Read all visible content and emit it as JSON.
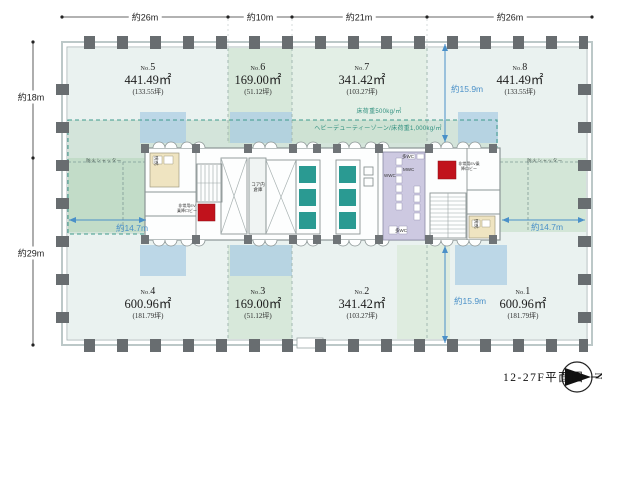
{
  "title": "12-27F平面図",
  "compass_north": "N",
  "dimensions": {
    "top": [
      "約26m",
      "約10m",
      "約21m",
      "約26m"
    ],
    "left_upper": "約18m",
    "left_lower": "約29m",
    "depth_left": "約14.7m",
    "depth_right": "約14.7m",
    "depth_top_right": "約15.9m",
    "depth_bottom_right": "約15.9m"
  },
  "floor_load": {
    "standard": "床荷重500kg/㎡",
    "heavy_duty": "ヘビーデューティーゾーン/床荷重1,000kg/㎡"
  },
  "fire_shutter_left": "防火シャッター",
  "fire_shutter_right": "防火シャッター",
  "rooms": [
    {
      "no_prefix": "No.",
      "no_number": "5",
      "area": "441.49㎡",
      "tsubo": "(133.55坪)"
    },
    {
      "no_prefix": "No.",
      "no_number": "6",
      "area": "169.00㎡",
      "tsubo": "(51.12坪)"
    },
    {
      "no_prefix": "No.",
      "no_number": "7",
      "area": "341.42㎡",
      "tsubo": "(103.27坪)"
    },
    {
      "no_prefix": "No.",
      "no_number": "8",
      "area": "441.49㎡",
      "tsubo": "(133.55坪)"
    },
    {
      "no_prefix": "No.",
      "no_number": "4",
      "area": "600.96㎡",
      "tsubo": "(181.79坪)"
    },
    {
      "no_prefix": "No.",
      "no_number": "3",
      "area": "169.00㎡",
      "tsubo": "(51.12坪)"
    },
    {
      "no_prefix": "No.",
      "no_number": "2",
      "area": "341.42㎡",
      "tsubo": "(103.27坪)"
    },
    {
      "no_prefix": "No.",
      "no_number": "1",
      "area": "600.96㎡",
      "tsubo": "(181.79坪)"
    }
  ],
  "core": {
    "storage": "コア内倉庫",
    "wc_women": "WWC",
    "wc_men": "MWC",
    "wc_multi_top": "多WC",
    "wc_multi_bottom": "多WC",
    "hot_water_left": "湯沸",
    "hot_water_right": "湯沸",
    "ev_lobby_left": "非常用EV乗降ロビー",
    "ev_lobby_right": "非常用EV乗降ロビー"
  },
  "colors": {
    "elevator_teal": "#2a9a92",
    "emergency_red": "#c1121c",
    "wc_lavender": "#cdc9e1",
    "hot_water_beige": "#efe4c1",
    "zone_green": "#d7e8da",
    "zone_blue": "#bdd5e8",
    "dimension_blue": "#4a90c8",
    "load_text_teal": "#2e8f7e",
    "column_gray": "#686d70"
  }
}
